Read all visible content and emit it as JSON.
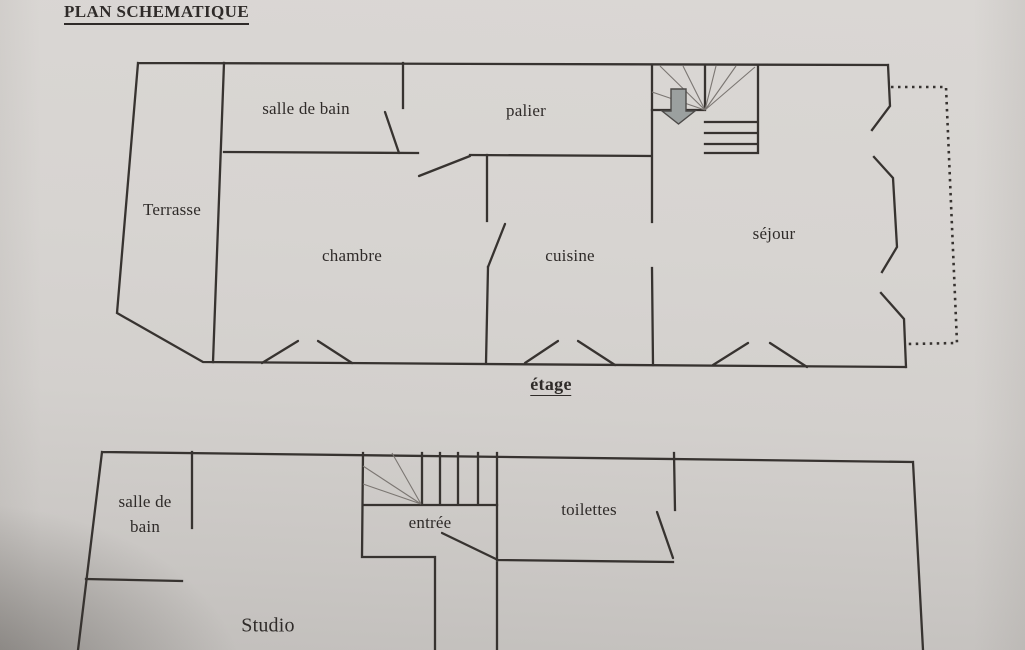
{
  "title": "PLAN SCHEMATIQUE",
  "colors": {
    "paper": "#d6d3d0",
    "ink": "#373330",
    "thin": "#7b7672",
    "arrow": "#9ba09f",
    "text": "#2f2b29"
  },
  "floors": {
    "upper": {
      "caption": "étage",
      "rooms": {
        "salle_de_bain": "salle de bain",
        "palier": "palier",
        "terrasse": "Terrasse",
        "chambre": "chambre",
        "cuisine": "cuisine",
        "sejour": "séjour"
      }
    },
    "lower": {
      "rooms": {
        "salle_de_bain_line1": "salle de",
        "salle_de_bain_line2": "bain",
        "entree": "entrée",
        "toilettes": "toilettes",
        "studio": "Studio"
      }
    }
  }
}
